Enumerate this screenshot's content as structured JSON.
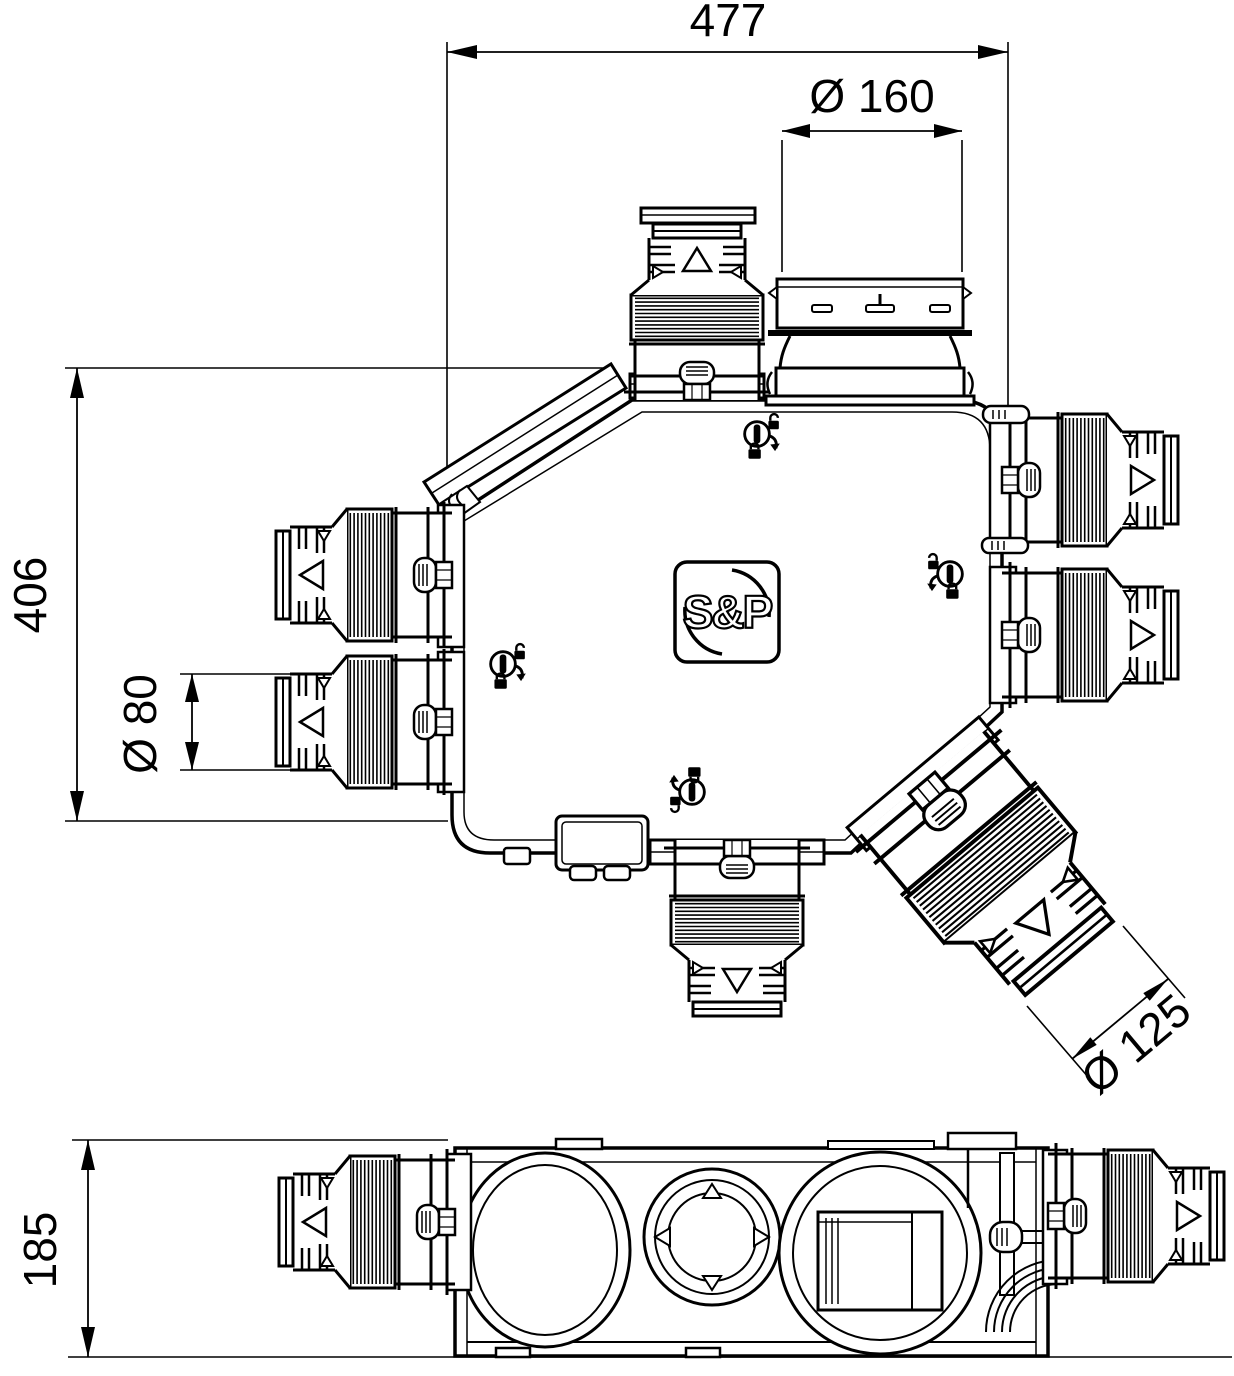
{
  "page": {
    "background": "#ffffff",
    "ink": "#000000"
  },
  "logo": {
    "text": "S&P"
  },
  "dimensions": {
    "overall_width": {
      "label": "477"
    },
    "top_port_diameter": {
      "label": "Ø 160"
    },
    "overall_depth": {
      "label": "406"
    },
    "left_port_diameter": {
      "label": "Ø 80"
    },
    "angled_port_diameter": {
      "label": "Ø 125"
    },
    "body_height": {
      "label": "185"
    }
  }
}
